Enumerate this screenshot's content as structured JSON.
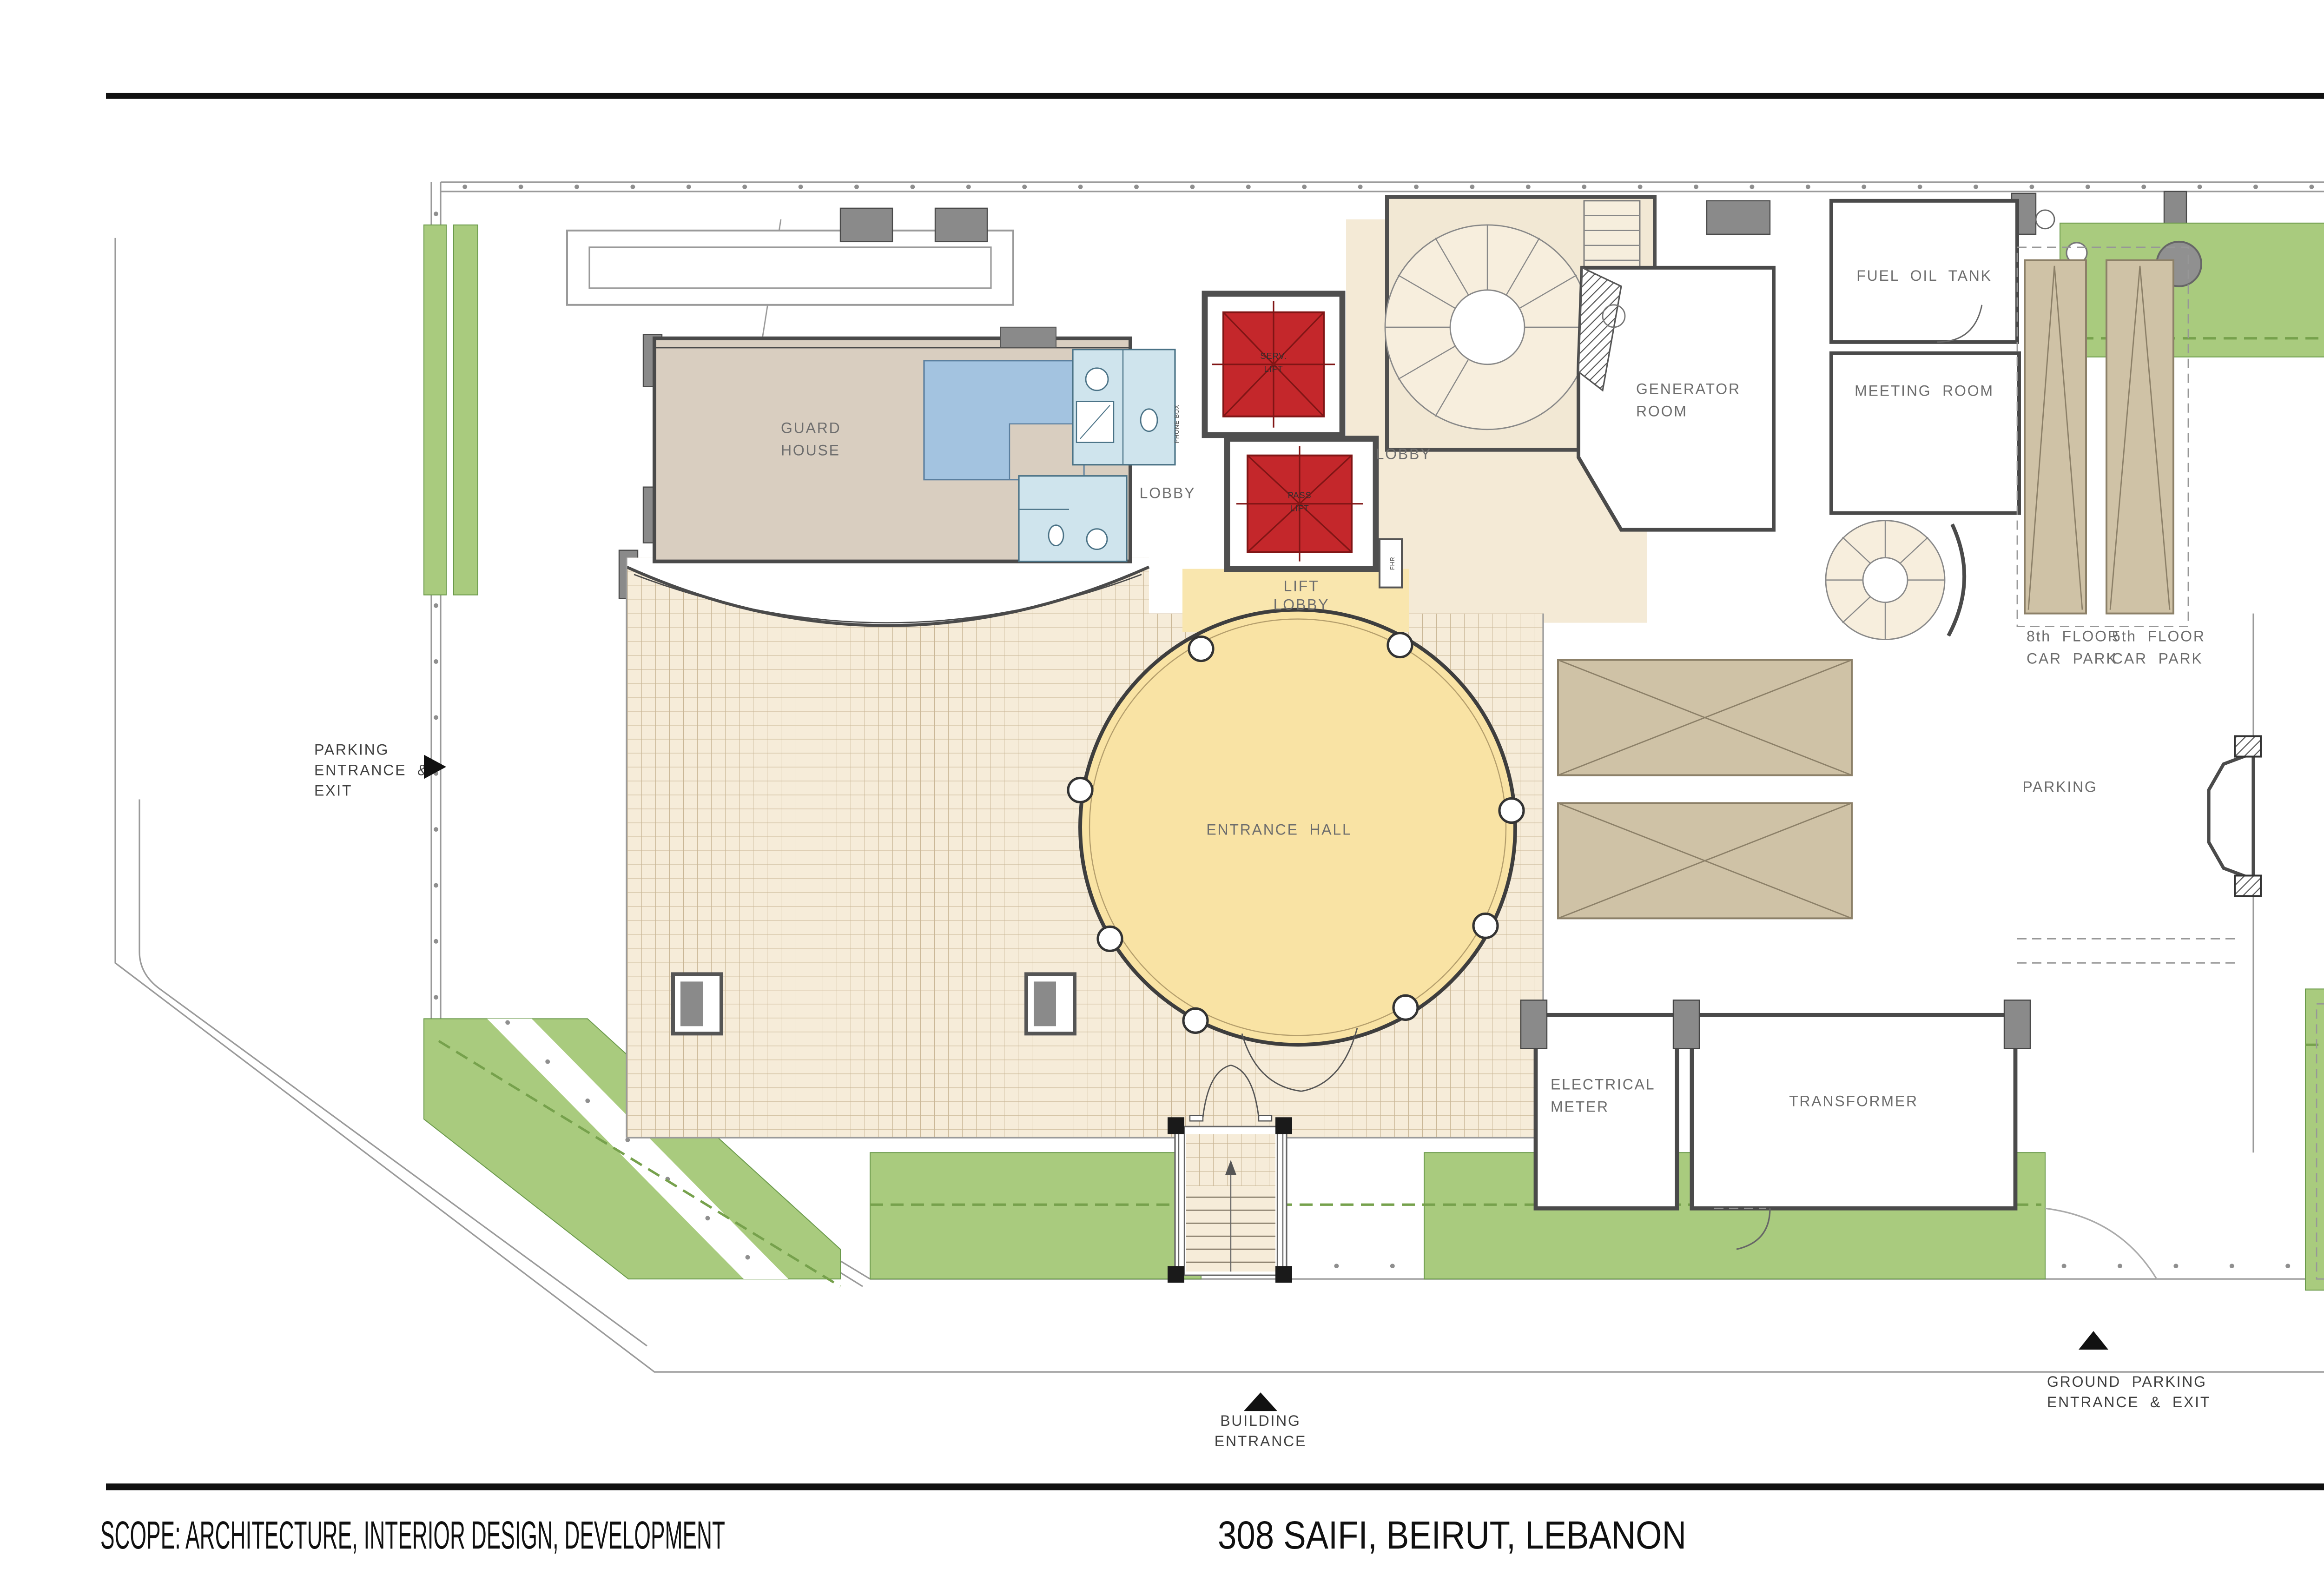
{
  "footer": {
    "scope": "SCOPE: ARCHITECTURE, INTERIOR DESIGN, DEVELOPMENT",
    "address": "308 SAIFI, BEIRUT, LEBANON",
    "logo": "XCASSIA"
  },
  "side": {
    "copyright": "© XCASSIA GLOBAL LIMITED . ALL RIGHTS RESERVED"
  },
  "plan": {
    "rooms": {
      "guard_house": [
        "GUARD",
        "HOUSE"
      ],
      "lobby_main": "LOBBY",
      "lobby_small": "LOBBY",
      "lift_lobby": [
        "LIFT",
        "LOBBY"
      ],
      "serv_lift": [
        "SERV.",
        "LIFT"
      ],
      "pass_lift": [
        "PASS",
        "LIFT"
      ],
      "fhr": "FHR",
      "phone_box": "PHONE BOX",
      "entrance_hall": "ENTRANCE HALL",
      "generator_room": [
        "GENERATOR",
        "ROOM"
      ],
      "fuel_oil_tank": "FUEL OIL TANK",
      "meeting_room": "MEETING ROOM",
      "car_park_8": [
        "8th FLOOR",
        "CAR PARK"
      ],
      "car_park_5": [
        "5th FLOOR",
        "CAR PARK"
      ],
      "parking": "PARKING",
      "electrical_meter": [
        "ELECTRICAL",
        "METER"
      ],
      "transformer": "TRANSFORMER"
    },
    "annotations": {
      "parking_entrance": [
        "PARKING",
        "ENTRANCE &",
        "EXIT"
      ],
      "ground_parking": [
        "GROUND PARKING",
        "ENTRANCE & EXIT"
      ],
      "building_entrance": [
        "BUILDING",
        "ENTRANCE"
      ]
    },
    "colors": {
      "green": "#a9cb7e",
      "cream": "#f6ecd9",
      "lobby_cream": "#f4ead6",
      "yellow": "#f9e3a4",
      "pale_yellow": "#f9e6ae",
      "beige": "#d9cec0",
      "tan": "#cfc2a6",
      "red": "#c4272b",
      "bed_blue": "#a3c3e0",
      "bath_blue": "#cfe4ed",
      "wall_gray": "#8a8a8a"
    }
  }
}
